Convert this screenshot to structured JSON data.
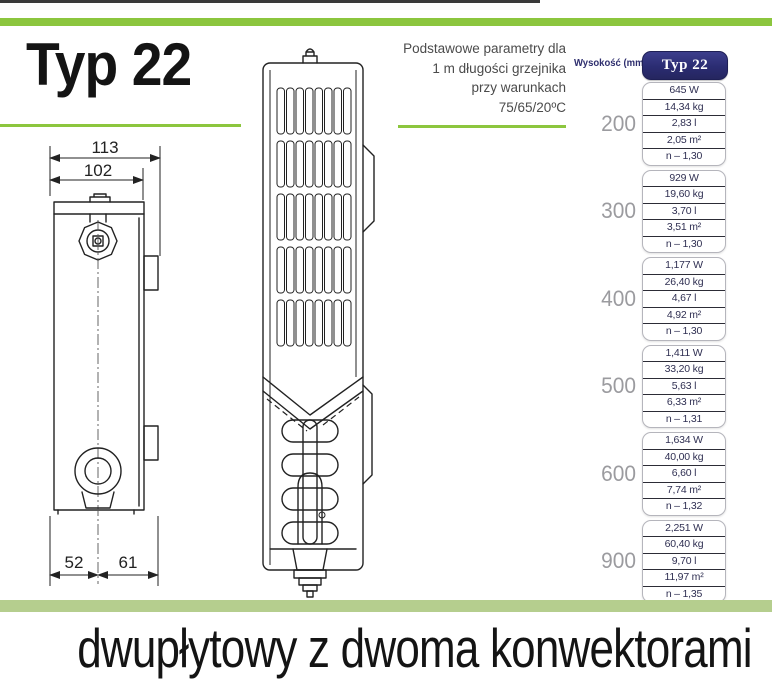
{
  "header": {
    "title": "Typ 22"
  },
  "params_note": {
    "lines": [
      "Podstawowe parametry dla",
      "1 m długości grzejnika",
      "przy warunkach",
      "75/65/20ºC"
    ]
  },
  "drawings": {
    "side_view": {
      "dims": {
        "total_width": "113",
        "inner_width": "102",
        "bottom_left": "52",
        "bottom_right": "61"
      }
    }
  },
  "table": {
    "height_label": "Wysokość (mm)",
    "column_header": "Typ 22",
    "groups": [
      {
        "height": "200",
        "values": [
          "645 W",
          "14,34 kg",
          "2,83 l",
          "2,05 m²",
          "n – 1,30"
        ]
      },
      {
        "height": "300",
        "values": [
          "929 W",
          "19,60 kg",
          "3,70 l",
          "3,51 m²",
          "n – 1,30"
        ]
      },
      {
        "height": "400",
        "values": [
          "1,177 W",
          "26,40 kg",
          "4,67 l",
          "4,92 m²",
          "n – 1,30"
        ]
      },
      {
        "height": "500",
        "values": [
          "1,411 W",
          "33,20 kg",
          "5,63 l",
          "6,33 m²",
          "n – 1,31"
        ]
      },
      {
        "height": "600",
        "values": [
          "1,634 W",
          "40,00 kg",
          "6,60 l",
          "7,74 m²",
          "n – 1,32"
        ]
      },
      {
        "height": "900",
        "values": [
          "2,251 W",
          "60,40 kg",
          "9,70 l",
          "11,97 m²",
          "n – 1,35"
        ]
      }
    ]
  },
  "footer": {
    "subtitle": "dwupłytowy z dwoma konwektorami"
  },
  "colors": {
    "accent_green": "#8CC63E",
    "pale_green": "#B5CE8E",
    "navy_badge": "#2B2C72",
    "table_text": "#2F2F52",
    "height_label_grey": "#9B9B9F"
  }
}
